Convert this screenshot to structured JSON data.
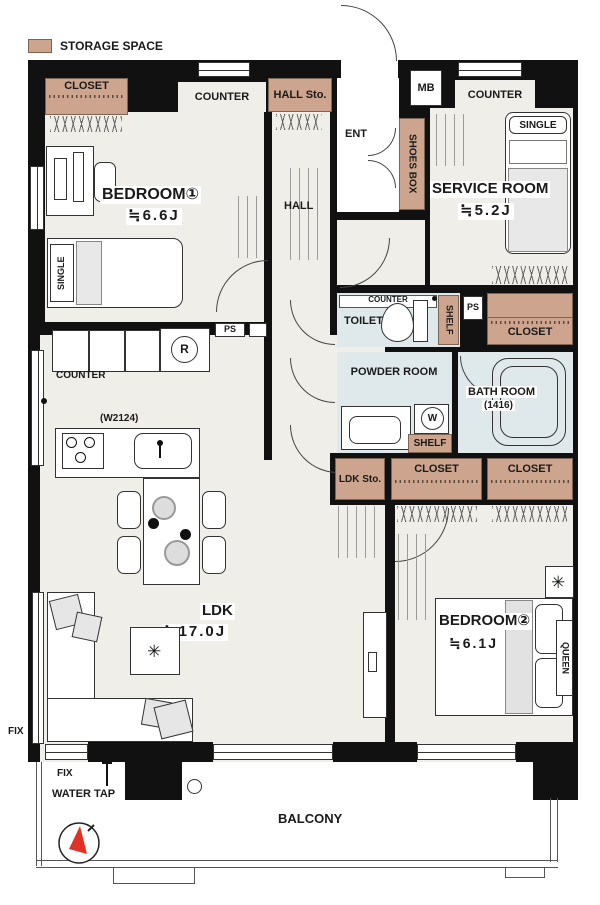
{
  "legend": {
    "label": "STORAGE SPACE"
  },
  "rooms": {
    "bedroom1": {
      "name": "BEDROOM①",
      "size": "≒6.6J"
    },
    "service": {
      "name": "SERVICE ROOM",
      "size": "≒5.2J"
    },
    "ldk": {
      "name": "LDK",
      "size": "≒17.0J"
    },
    "bedroom2": {
      "name": "BEDROOM②",
      "size": "≒6.1J"
    },
    "hall": {
      "name": "HALL"
    },
    "entrance": {
      "name": "ENT"
    },
    "toilet": {
      "name": "TOILET"
    },
    "powder": {
      "name": "POWDER ROOM"
    },
    "bath": {
      "name": "BATH ROOM",
      "size": "(1416)"
    },
    "balcony": {
      "name": "BALCONY"
    }
  },
  "storage": {
    "closet_bedroom1": "CLOSET",
    "hall_storage": "HALL Sto.",
    "shoes_box": "SHOES BOX",
    "closet_service": "CLOSET",
    "shelf_toilet": "SHELF",
    "shelf_powder": "SHELF",
    "ldk_storage": "LDK Sto.",
    "closet_bedroom2_left": "CLOSET",
    "closet_bedroom2_right": "CLOSET"
  },
  "fixtures": {
    "counter_bedroom1": "COUNTER",
    "counter_service": "COUNTER",
    "counter_ldk": "COUNTER",
    "counter_toilet": "COUNTER",
    "meter_box": "MB",
    "pipe_space_1": "PS",
    "pipe_space_2": "PS",
    "kitchen_width": "(W2124)",
    "refrigerator": "R",
    "washer": "W",
    "water_tap": "WATER TAP",
    "fix_left": "FIX",
    "fix_bottom": "FIX"
  },
  "furniture": {
    "bed_bedroom1": "SINGLE",
    "bed_service": "SINGLE",
    "bed_bedroom2": "QUEEN"
  },
  "icons": {
    "plant": "✳"
  },
  "colors": {
    "storage": "#cda58e",
    "floor": "#f0eee8",
    "wet": "#dfe9ec",
    "wall": "#111111",
    "compass_red": "#e03127"
  }
}
